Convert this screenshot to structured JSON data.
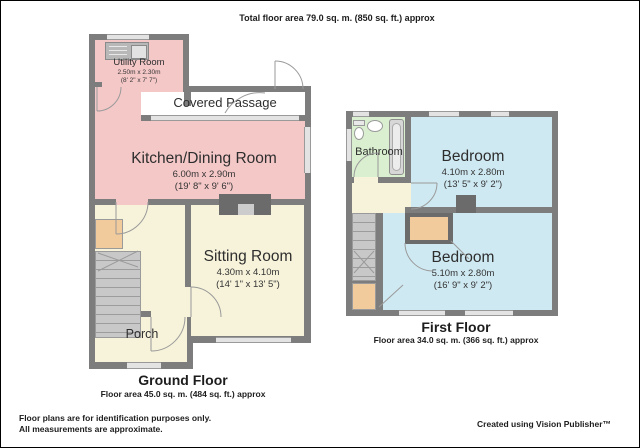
{
  "header": {
    "total_area": "Total floor area 79.0 sq. m. (850 sq. ft.) approx"
  },
  "ground_floor": {
    "label": "Ground Floor",
    "area": "Floor area 45.0 sq. m. (484 sq. ft.) approx",
    "rooms": {
      "utility": {
        "name": "Utility Room",
        "dims_m": "2.50m x 2.30m",
        "dims_ft": "(8' 2\" x 7' 7\")"
      },
      "covered_passage": {
        "name": "Covered Passage"
      },
      "kitchen": {
        "name": "Kitchen/Dining Room",
        "dims_m": "6.00m x 2.90m",
        "dims_ft": "(19' 8\" x 9' 6\")"
      },
      "sitting": {
        "name": "Sitting Room",
        "dims_m": "4.30m x 4.10m",
        "dims_ft": "(14' 1\" x 13' 5\")"
      },
      "porch": {
        "name": "Porch"
      }
    }
  },
  "first_floor": {
    "label": "First Floor",
    "area": "Floor area 34.0 sq. m. (366 sq. ft.) approx",
    "rooms": {
      "bathroom": {
        "name": "Bathroom"
      },
      "bedroom1": {
        "name": "Bedroom",
        "dims_m": "4.10m x 2.80m",
        "dims_ft": "(13' 5\" x 9' 2\")"
      },
      "bedroom2": {
        "name": "Bedroom",
        "dims_m": "5.10m x 2.80m",
        "dims_ft": "(16' 9\" x 9' 2\")"
      }
    }
  },
  "footer": {
    "line1": "Floor plans are for identification purposes only.",
    "line2": "All measurements are approximate.",
    "credit": "Created using Vision Publisher™"
  },
  "colors": {
    "wall": "#7d7d7d",
    "room_pink": "#f5c8c8",
    "room_cream": "#f7f3da",
    "room_blue": "#cfe9f2",
    "room_green": "#d9efcf",
    "cupboard_orange": "#f1cb9b",
    "window": "#e3e3e3",
    "dark_fixture": "#6b6b6b",
    "background": "#ffffff"
  }
}
